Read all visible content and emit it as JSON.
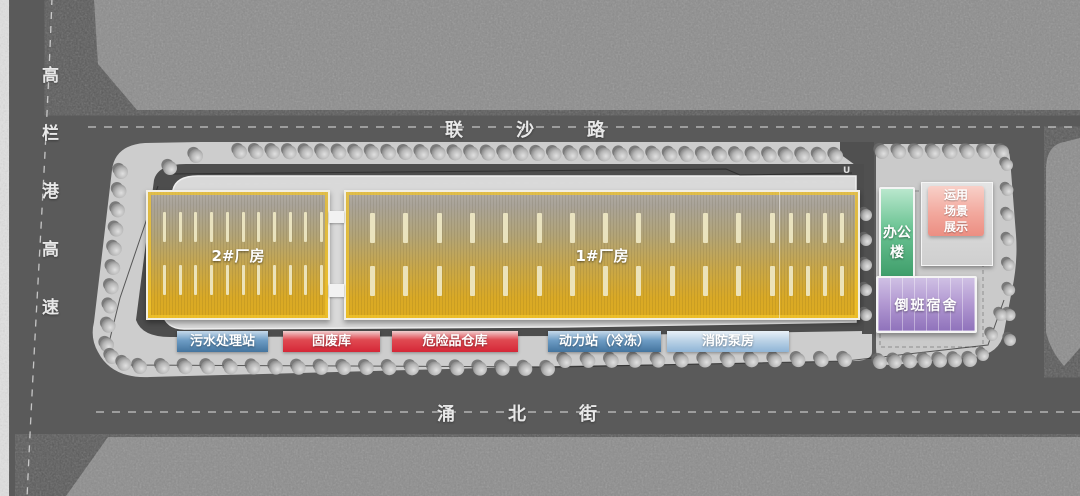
{
  "roads": {
    "left_highway": "高栏港高速",
    "top": "联沙路",
    "bottom": "涌北街",
    "u_marking": "U"
  },
  "buildings": {
    "factory2": "2#厂房",
    "factory1": "1#厂房",
    "office": "办公楼",
    "dormitory": "倒班宿舍",
    "scene_display": "运用场景展示"
  },
  "facilities": [
    {
      "label": "污水处理站",
      "color": "blue"
    },
    {
      "label": "固废库",
      "color": "red"
    },
    {
      "label": "危险品仓库",
      "color": "red"
    },
    {
      "label": "动力站（冷冻）",
      "color": "blue"
    },
    {
      "label": "消防泵房",
      "color": "blue-light"
    }
  ],
  "colors": {
    "road_gray": "#5a5a5a",
    "parcel_gray": "#8c8c8c",
    "site_gray": "#cdcdcd",
    "factory_top": "#a9a399",
    "factory_gold": "#ddab20",
    "factory_accent": "#f2c42c",
    "office_green": "#3f9e6b",
    "dormitory_purple": "#8f72bb",
    "scene_pink": "#ec8e82",
    "label_blue": "#44749e",
    "label_red": "#d52737",
    "label_blue_light": "#8fb4d6"
  }
}
